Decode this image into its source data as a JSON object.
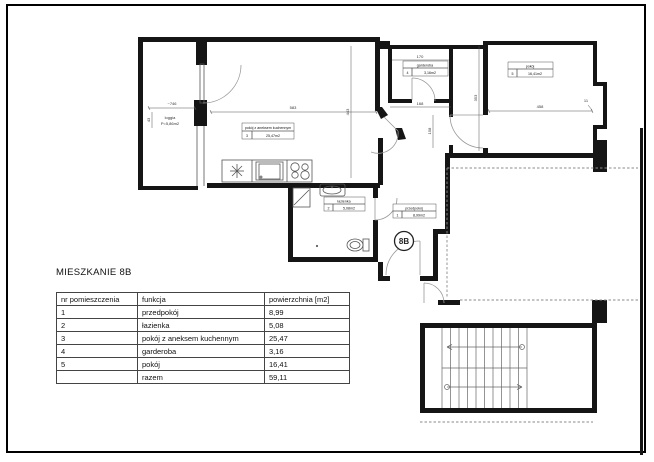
{
  "page": {
    "title": "MIESZKANIE 8B"
  },
  "plan": {
    "badge": "8B",
    "loggia_label": "loggia",
    "loggia_area": "P=5,86m2",
    "labels": {
      "room1": {
        "name": "przedpokój",
        "nr": "1",
        "area": "8,99m2"
      },
      "room2": {
        "name": "łazienka",
        "nr": "2",
        "area": "5,08m2"
      },
      "room3": {
        "name": "pokój z aneksem kuchennym",
        "nr": "3",
        "area": "25,47m2"
      },
      "room4": {
        "name": "garderoba",
        "nr": "4",
        "area": "3,16m2"
      },
      "room5": {
        "name": "pokój",
        "nr": "5",
        "area": "16,41m2"
      }
    },
    "dims": {
      "d_loggia_w": "~746",
      "d_loggia_h": "43",
      "d_room3_w": "583",
      "d_room3_h": "443",
      "d_gard_w": "170",
      "d_hall_w": "168",
      "d_hall_h": "158",
      "d_room5_w": "458",
      "d_room5_h": "353",
      "d_jamb": "11"
    }
  },
  "table": {
    "headers": [
      "nr pomieszczenia",
      "funkcja",
      "powierzchnia [m2]"
    ],
    "rows": [
      {
        "nr": "1",
        "funkcja": "przedpokój",
        "area": "8,99"
      },
      {
        "nr": "2",
        "funkcja": "łazienka",
        "area": "5,08"
      },
      {
        "nr": "3",
        "funkcja": "pokój z aneksem kuchennym",
        "area": "25,47"
      },
      {
        "nr": "4",
        "funkcja": "garderoba",
        "area": "3,16"
      },
      {
        "nr": "5",
        "funkcja": "pokój",
        "area": "16,41"
      }
    ],
    "total_label": "razem",
    "total_value": "59,11"
  }
}
